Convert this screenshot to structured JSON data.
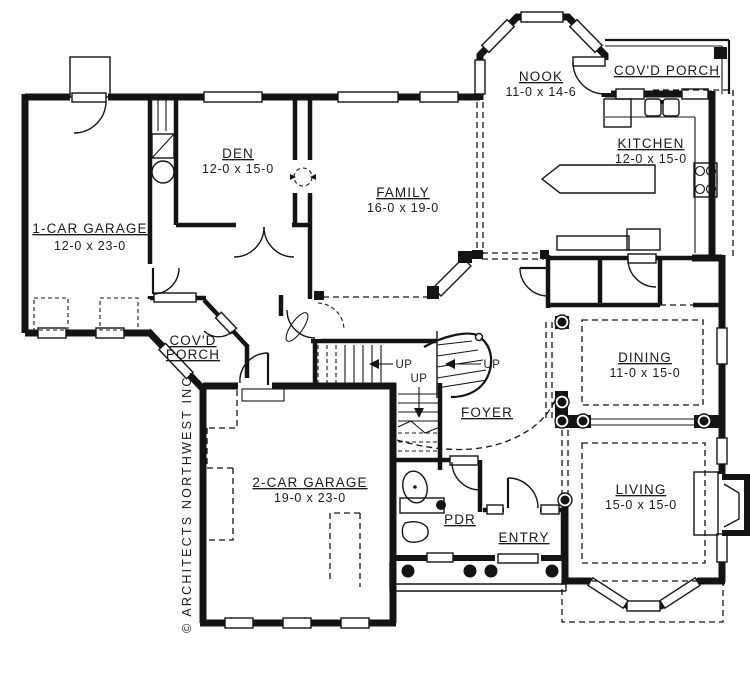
{
  "branding": "© ARCHITECTS NORTHWEST INC.",
  "rooms": {
    "garage1": {
      "name": "1-CAR GARAGE",
      "dims": "12-0 x 23-0"
    },
    "den": {
      "name": "DEN",
      "dims": "12-0 x 15-0"
    },
    "family": {
      "name": "FAMILY",
      "dims": "16-0 x 19-0"
    },
    "nook": {
      "name": "NOOK",
      "dims": "11-0 x 14-6"
    },
    "porch_right": {
      "name": "COV'D PORCH"
    },
    "kitchen": {
      "name": "KITCHEN",
      "dims": "12-0 x 15-0"
    },
    "porch_left": {
      "line1": "COV'D",
      "line2": "PORCH"
    },
    "dining": {
      "name": "DINING",
      "dims": "11-0 x 15-0"
    },
    "living": {
      "name": "LIVING",
      "dims": "15-0 x 15-0"
    },
    "garage2": {
      "name": "2-CAR GARAGE",
      "dims": "19-0 x 23-0"
    },
    "foyer": {
      "name": "FOYER"
    },
    "pdr": {
      "name": "PDR"
    },
    "entry": {
      "name": "ENTRY"
    }
  },
  "stairs": {
    "up_left": "UP",
    "up_right": "UP",
    "up_lower": "UP"
  },
  "colors": {
    "ink": "#141414",
    "paper": "#ffffff"
  }
}
